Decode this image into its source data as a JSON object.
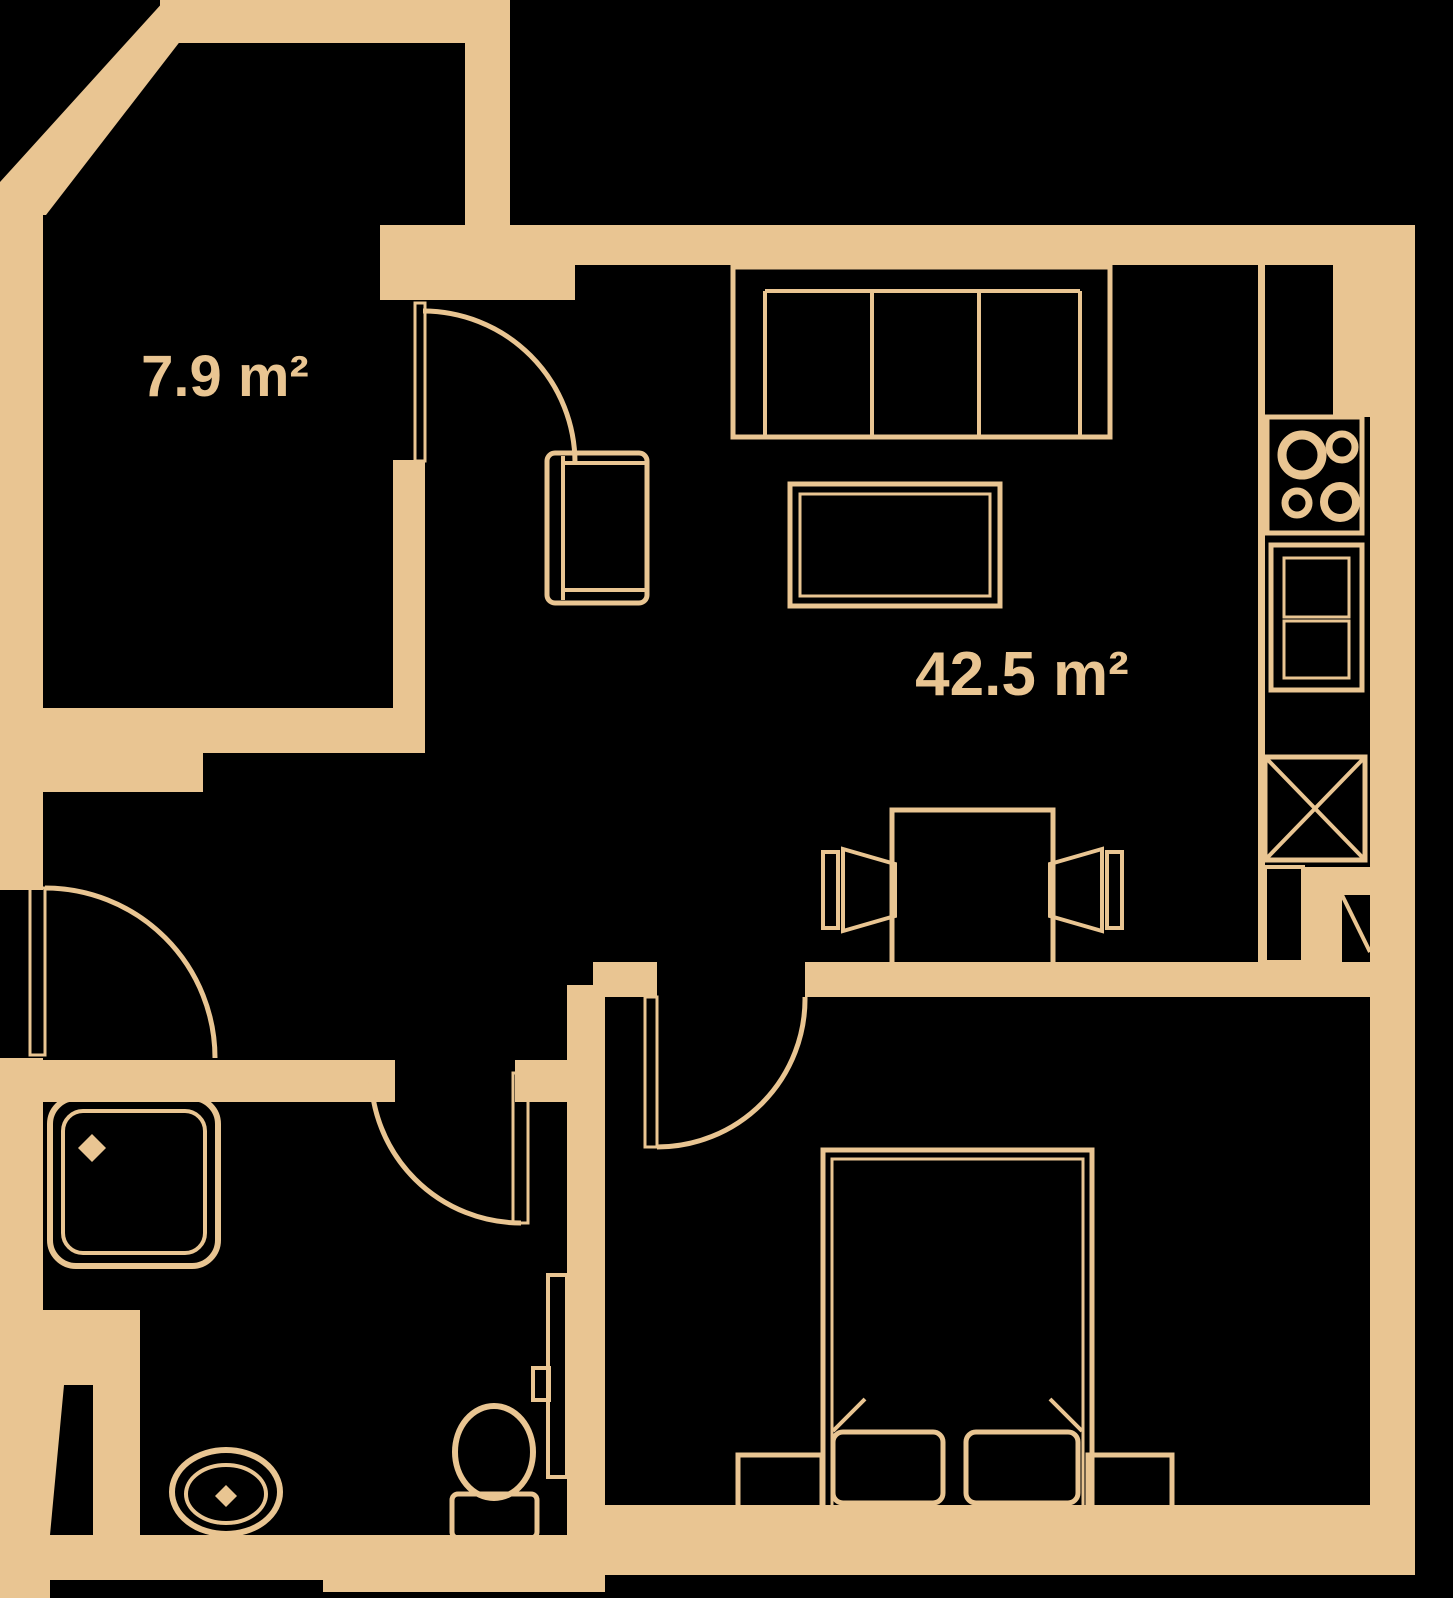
{
  "title": "Apartment floor plan",
  "colors": {
    "background": "#000000",
    "wall": "#e9c592"
  },
  "rooms": {
    "balcony": {
      "name": "balcony-room",
      "area_label": "7.9 m²"
    },
    "living_kitchen": {
      "name": "living-room-with-kitchen",
      "area_label": "42.5 m²"
    }
  }
}
